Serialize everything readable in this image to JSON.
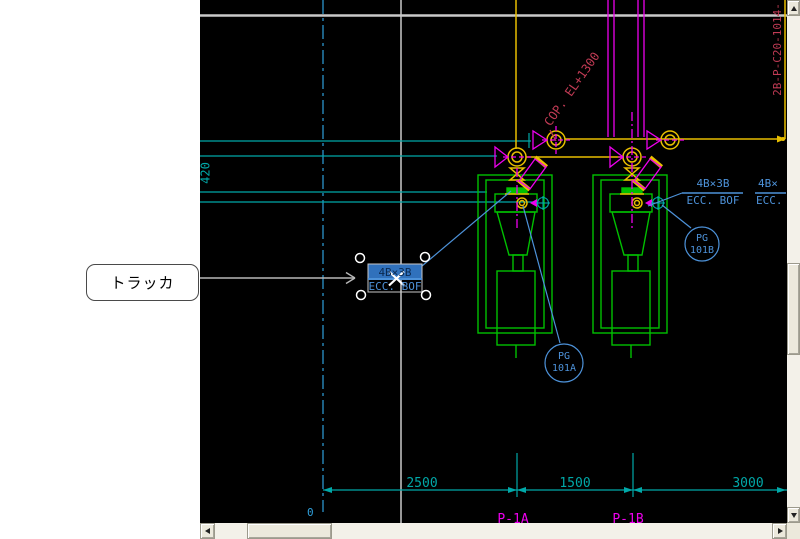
{
  "callout": {
    "text": "トラッカ"
  },
  "drawing": {
    "colors": {
      "background": "#000000",
      "teal": "#00a8a8",
      "green": "#00c000",
      "yellow": "#e7be00",
      "magenta": "#ee00ee",
      "steel_blue": "#4d92d9",
      "crimson": "#c23b55",
      "crosshair_white": "#ffffff",
      "grid_gray": "#c9c9c9",
      "centerline_cyan": "#2fa0dc"
    },
    "texts": {
      "dim_420": "420",
      "dim_2500": "2500",
      "dim_1500": "1500",
      "dim_3000": "3000",
      "dim_zero": "0",
      "cop_label": "COP. EL+1300",
      "line_tag": "2B-P-C20-1014-",
      "pg_a_top": "PG",
      "pg_a_bottom": "101A",
      "pg_b_top": "PG",
      "pg_b_bottom": "101B",
      "reducer_label_top": "4B×3B",
      "reducer_label_bottom": "ECC. BOF",
      "reducer_label2_top": "4B×",
      "reducer_label2_bottom": "ECC.",
      "tracked_label_top": "4B×3B",
      "tracked_label_bottom": "ECC. BOF",
      "pump_a_tag": "P-1A",
      "pump_b_tag": "P-1B"
    }
  }
}
